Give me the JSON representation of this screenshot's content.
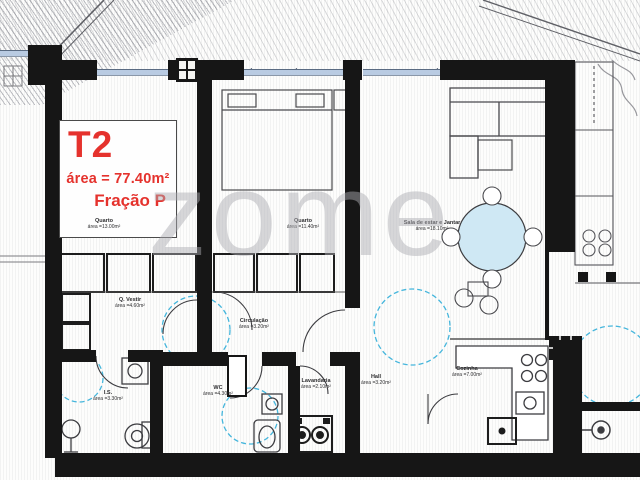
{
  "watermark": "zome",
  "unit_box": {
    "type": "T2",
    "area": "área = 77.40m²",
    "fraction": "Fração P"
  },
  "rooms": [
    {
      "name": "Quarto",
      "area": "área =13.00m²"
    },
    {
      "name": "Quarto",
      "area": "área =11.40m²"
    },
    {
      "name": "Sala de estar e Jantar",
      "area": "área =18.10m²"
    },
    {
      "name": "Q. Vestir",
      "area": "área =4.60m²"
    },
    {
      "name": "Circulação",
      "area": "área =3.20m²"
    },
    {
      "name": "I.S.",
      "area": "área =3.30m²"
    },
    {
      "name": "WC",
      "area": "área =4.30m²"
    },
    {
      "name": "Lavandaria",
      "area": "área =2.10m²"
    },
    {
      "name": "Hall",
      "area": "área =3.20m²"
    },
    {
      "name": "Cozinha",
      "area": "área =7.00m²"
    }
  ],
  "colors": {
    "wall": "#161616",
    "thin_line": "#474747",
    "dashed_zone": "#45b6dc",
    "table_fill": "#cfe8f4",
    "accent_red": "#e5322d",
    "watermark_gray": "#acacb1"
  }
}
